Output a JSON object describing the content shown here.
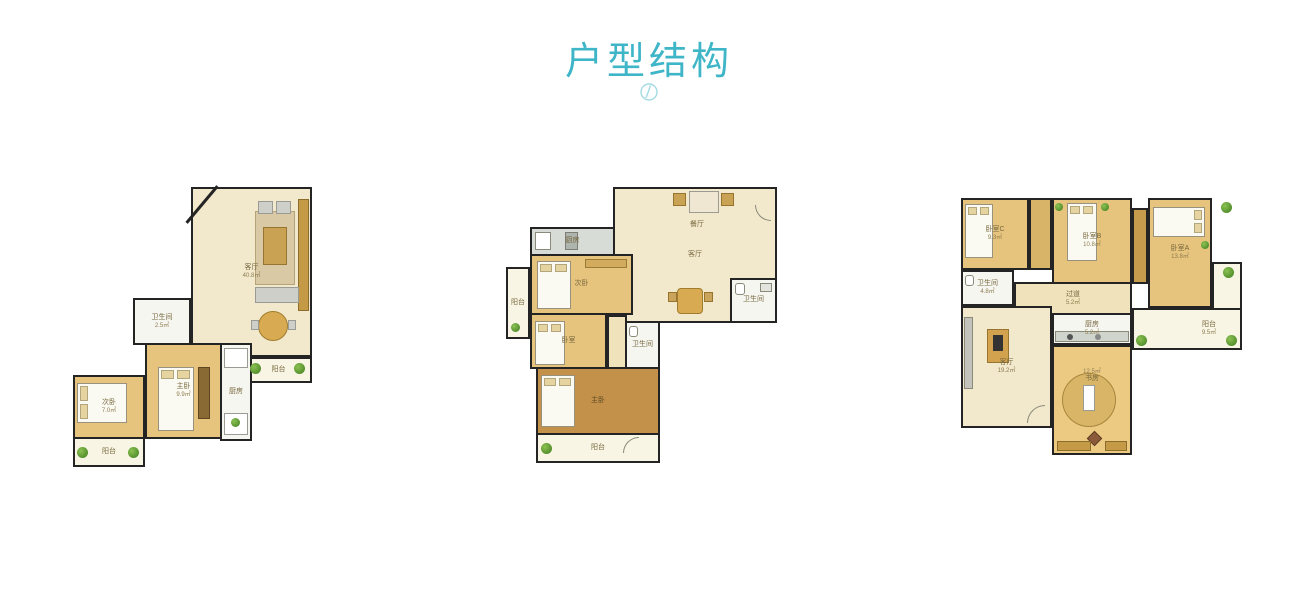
{
  "header": {
    "title": "户型结构",
    "icon": "clock-icon",
    "accent_color": "#3fb5c8"
  },
  "colors": {
    "wall": "#242424",
    "living_fill": "#f2e8cc",
    "bedroom_fill": "#e7c47d",
    "wood_fill": "#c4914a",
    "utility_fill": "#f6f6f1",
    "balcony_fill": "#f8f5e4",
    "plant_green": "#4e8c2a"
  },
  "floorplans": [
    {
      "id": "floorplan-1",
      "rooms": {
        "living": {
          "label": "客厅",
          "area": "40.8㎡"
        },
        "balcony_right": {
          "label": "阳台",
          "area": "2.9㎡"
        },
        "bath": {
          "label": "卫生间",
          "area": "2.5㎡"
        },
        "bedroom_master": {
          "label": "主卧",
          "area": "9.9㎡"
        },
        "bedroom_second": {
          "label": "次卧",
          "area": "7.0㎡"
        },
        "kitchen": {
          "label": "厨房",
          "area": "4.7㎡"
        },
        "balcony_bottom": {
          "label": "阳台",
          "area": "4.7㎡"
        }
      }
    },
    {
      "id": "floorplan-2",
      "rooms": {
        "dining": {
          "label": "餐厅"
        },
        "living": {
          "label": "客厅"
        },
        "kitchen": {
          "label": "厨房"
        },
        "bedroom_top": {
          "label": "次卧"
        },
        "balcony_left": {
          "label": "阳台"
        },
        "bedroom_mid": {
          "label": "卧室"
        },
        "bath_right": {
          "label": "卫生间"
        },
        "bath_small": {
          "label": "卫生间"
        },
        "bedroom_master": {
          "label": "主卧"
        },
        "balcony_bottom": {
          "label": "阳台"
        }
      }
    },
    {
      "id": "floorplan-3",
      "rooms": {
        "bedroom_c": {
          "label": "卧室C",
          "area": "9.3㎡"
        },
        "bedroom_b": {
          "label": "卧室B",
          "area": "10.8㎡"
        },
        "bedroom_a": {
          "label": "卧室A",
          "area": "13.8㎡"
        },
        "bath": {
          "label": "卫生间",
          "area": "4.8㎡"
        },
        "hallway": {
          "label": "过道",
          "area": "5.2㎡"
        },
        "kitchen": {
          "label": "厨房",
          "area": "5.2㎡"
        },
        "living": {
          "label": "客厅",
          "area": "19.2㎡"
        },
        "study": {
          "label": "书房",
          "area": "12.5㎡"
        },
        "balcony": {
          "label": "阳台",
          "area": "9.5㎡"
        }
      }
    }
  ]
}
